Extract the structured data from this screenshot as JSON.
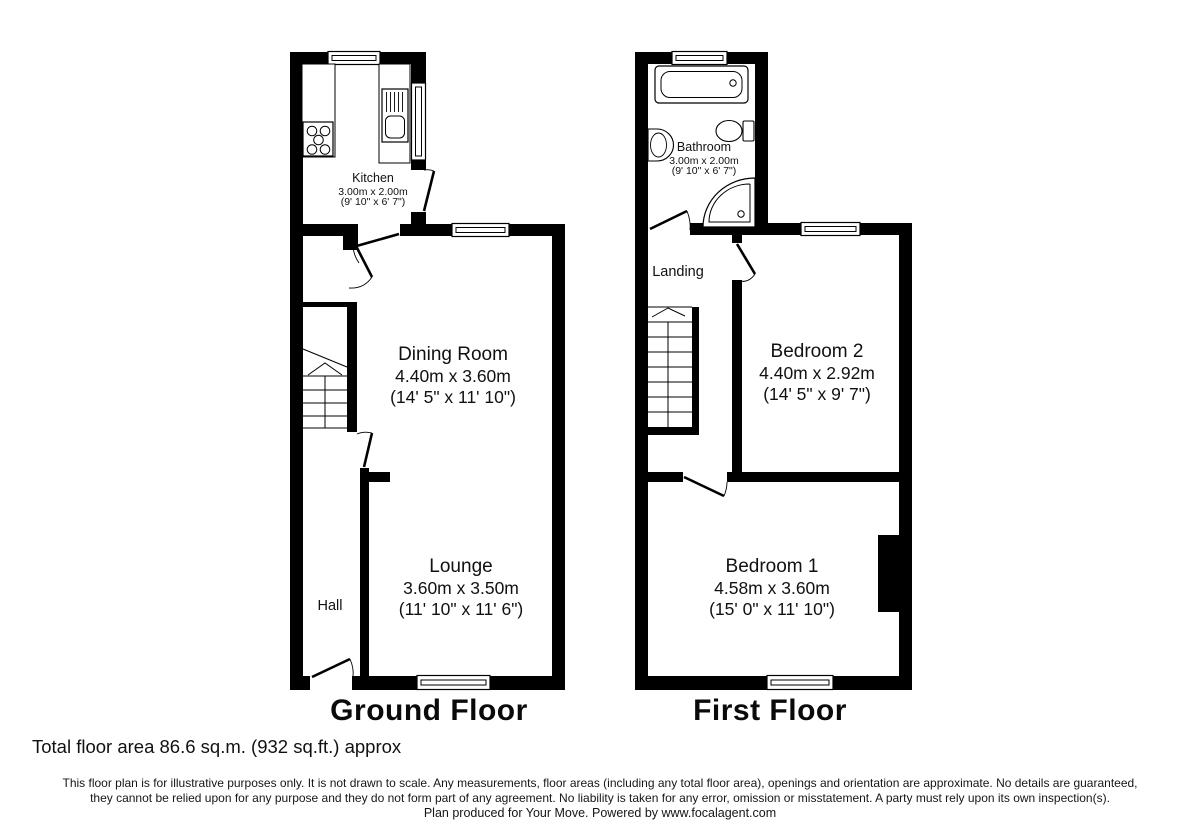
{
  "ground_floor": {
    "title": "Ground Floor",
    "rooms": [
      {
        "name": "Kitchen",
        "metric": "3.00m x 2.00m",
        "imperial": "(9' 10\" x 6' 7\")"
      },
      {
        "name": "Dining Room",
        "metric": "4.40m x 3.60m",
        "imperial": "(14' 5\" x 11' 10\")"
      },
      {
        "name": "Lounge",
        "metric": "3.60m x 3.50m",
        "imperial": "(11' 10\" x 11' 6\")"
      },
      {
        "name": "Hall"
      }
    ]
  },
  "first_floor": {
    "title": "First Floor",
    "rooms": [
      {
        "name": "Bathroom",
        "metric": "3.00m x 2.00m",
        "imperial": "(9' 10\" x 6' 7\")"
      },
      {
        "name": "Landing"
      },
      {
        "name": "Bedroom 2",
        "metric": "4.40m x 2.92m",
        "imperial": "(14' 5\" x 9' 7\")"
      },
      {
        "name": "Bedroom 1",
        "metric": "4.58m x 3.60m",
        "imperial": "(15' 0\" x 11' 10\")"
      }
    ]
  },
  "footer": {
    "total_area": "Total floor area 86.6 sq.m. (932 sq.ft.) approx",
    "disclaimer_line1": "This floor plan is for illustrative purposes only. It is not drawn to scale. Any measurements, floor areas (including any total floor area), openings and orientation are approximate. No details are guaranteed,",
    "disclaimer_line2": "they cannot be relied upon for any purpose and they do not form part of any agreement. No liability is taken for any error, omission or misstatement. A party must rely upon its own inspection(s).",
    "credit": "Plan produced for Your Move. Powered by www.focalagent.com"
  },
  "colors": {
    "wall": "#000000",
    "line": "#000000",
    "background": "#ffffff",
    "text": "#111111"
  }
}
